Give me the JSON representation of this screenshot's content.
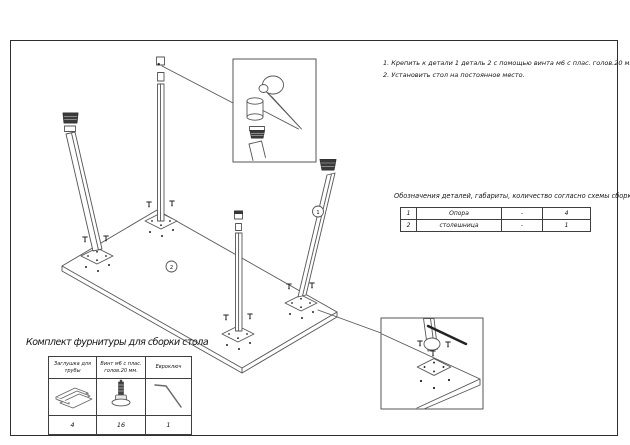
{
  "instructions": {
    "line1": "1. Крепить к детали 1 деталь 2 с помощью винта м6 с плас. голов.20 мм.",
    "line2": "2. Установить стол на постоянное место."
  },
  "parts_table": {
    "title": "Обозначения деталей, габариты, количество согласно схемы сборки",
    "rows": [
      {
        "num": "1",
        "name": "Опора",
        "dims": "-",
        "qty": "4"
      },
      {
        "num": "2",
        "name": "столешница",
        "dims": "-",
        "qty": "1"
      }
    ]
  },
  "hardware_kit": {
    "title": "Комплект фурнитуры для сборки стола",
    "columns": [
      {
        "label": "Заглушка для трубы",
        "qty": "4"
      },
      {
        "label": "Винт м6 с плас. голов.20 мм.",
        "qty": "16"
      },
      {
        "label": "Евроключ",
        "qty": "1"
      }
    ]
  },
  "diagram": {
    "label_leg": "1",
    "label_top": "2"
  },
  "colors": {
    "line": "#555555",
    "dark_fill": "#3a3a3a",
    "frame": "#2e2e2e"
  }
}
